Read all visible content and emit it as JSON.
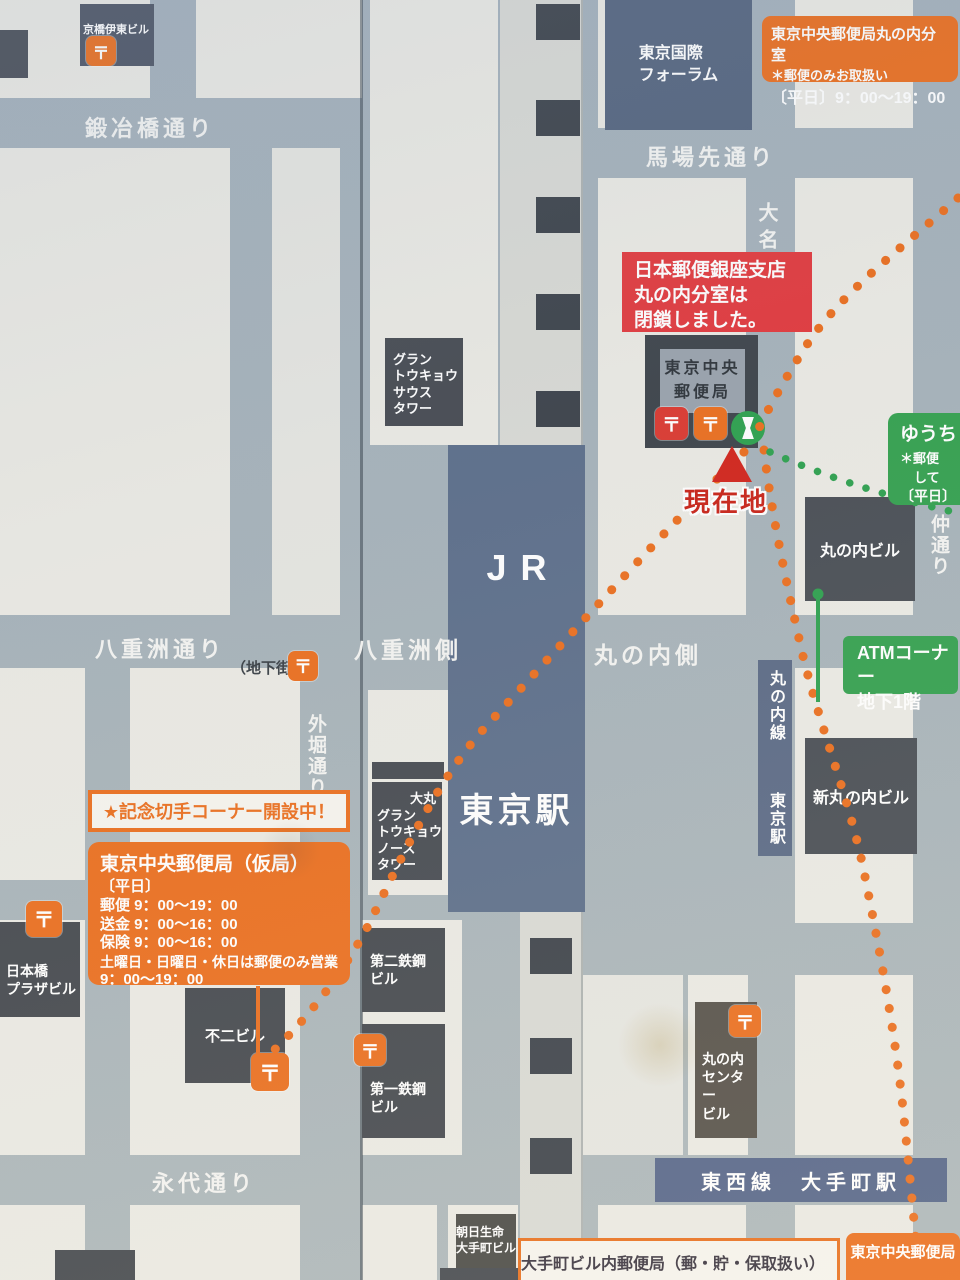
{
  "icons": {
    "postal": "〒"
  },
  "colors": {
    "road": "#a6b2ba",
    "block": "#ebeae4",
    "building_dark": "#45494f",
    "building_blue": "#5b6d89",
    "accent_orange": "#EB6F1F",
    "alert_red": "#E23A3E",
    "green": "#34A14F",
    "subway_band_blue": "#5b6a86",
    "current_location_red": "#C92A1A"
  },
  "streets": {
    "kajibashi": "鍛冶橋通り",
    "babasaki": "馬場先通り",
    "daimyo_koji": "大名小路",
    "yaesu_dori": "八重洲通り",
    "chikagai": "（地下街）",
    "yaesu_side": "八重洲側",
    "marunouchi_side": "丸の内側",
    "sotobori_dori": "外堀通り",
    "naka_dori": "仲通り",
    "eitai_dori": "永代通り",
    "marunouchi_line": "丸の内線",
    "marunouchi_line_station": "東京駅",
    "tozai_line": "東西線　大手町駅"
  },
  "station": {
    "jr": "JR",
    "name": "東京駅"
  },
  "buildings": {
    "kyobashi_ito": "京橋伊東ビル",
    "tokyo_forum": "東京国際\nフォーラム",
    "gran_tokyo_south": "グラン\nトウキョウ\nサウス\nタワー",
    "central_post_office": "東京中央\n郵便局",
    "marunouchi_bldg": "丸の内ビル",
    "shin_marunouchi_bldg": "新丸の内ビル",
    "daimaru": "大丸",
    "gran_tokyo_north": "グラン\nトウキョウ\nノース\nタワー",
    "tekko2": "第二鉄鋼\nビル",
    "tekko1": "第一鉄鋼\nビル",
    "nihonbashi_plaza": "日本橋\nプラザビル",
    "fuji": "不二ビル",
    "marunouchi_center": "丸の内\nセンター\nビル",
    "asahi_seimei": "朝日生命\n大手町ビル"
  },
  "callouts": {
    "bunshitsu": {
      "title": "東京中央郵便局丸の内分室",
      "note": "＊郵便のみお取扱い",
      "hours": "〔平日〕9：00～19：00"
    },
    "closed_notice": "日本郵便銀座支店\n丸の内分室は\n閉鎖しました。",
    "current_location": "現在地",
    "yucho": [
      "ゆうち",
      "＊郵便",
      "して",
      "〔平日〕"
    ],
    "atm_corner": "ATMコーナー\n地下1階",
    "stamp_banner": "★記念切手コーナー開設中！",
    "temp_office": {
      "title": "東京中央郵便局（仮局）",
      "lines": [
        "〔平日〕",
        "郵便 9：00～19：00",
        "送金 9：00～16：00",
        "保険 9：00～16：00",
        "土曜日・日曜日・休日は郵便のみ営業",
        "9：00～19：00"
      ]
    },
    "otemachi_note": "大手町ビル内郵便局（郵・貯・保取扱い）と",
    "bottom_orange": "東京中央郵便局"
  }
}
